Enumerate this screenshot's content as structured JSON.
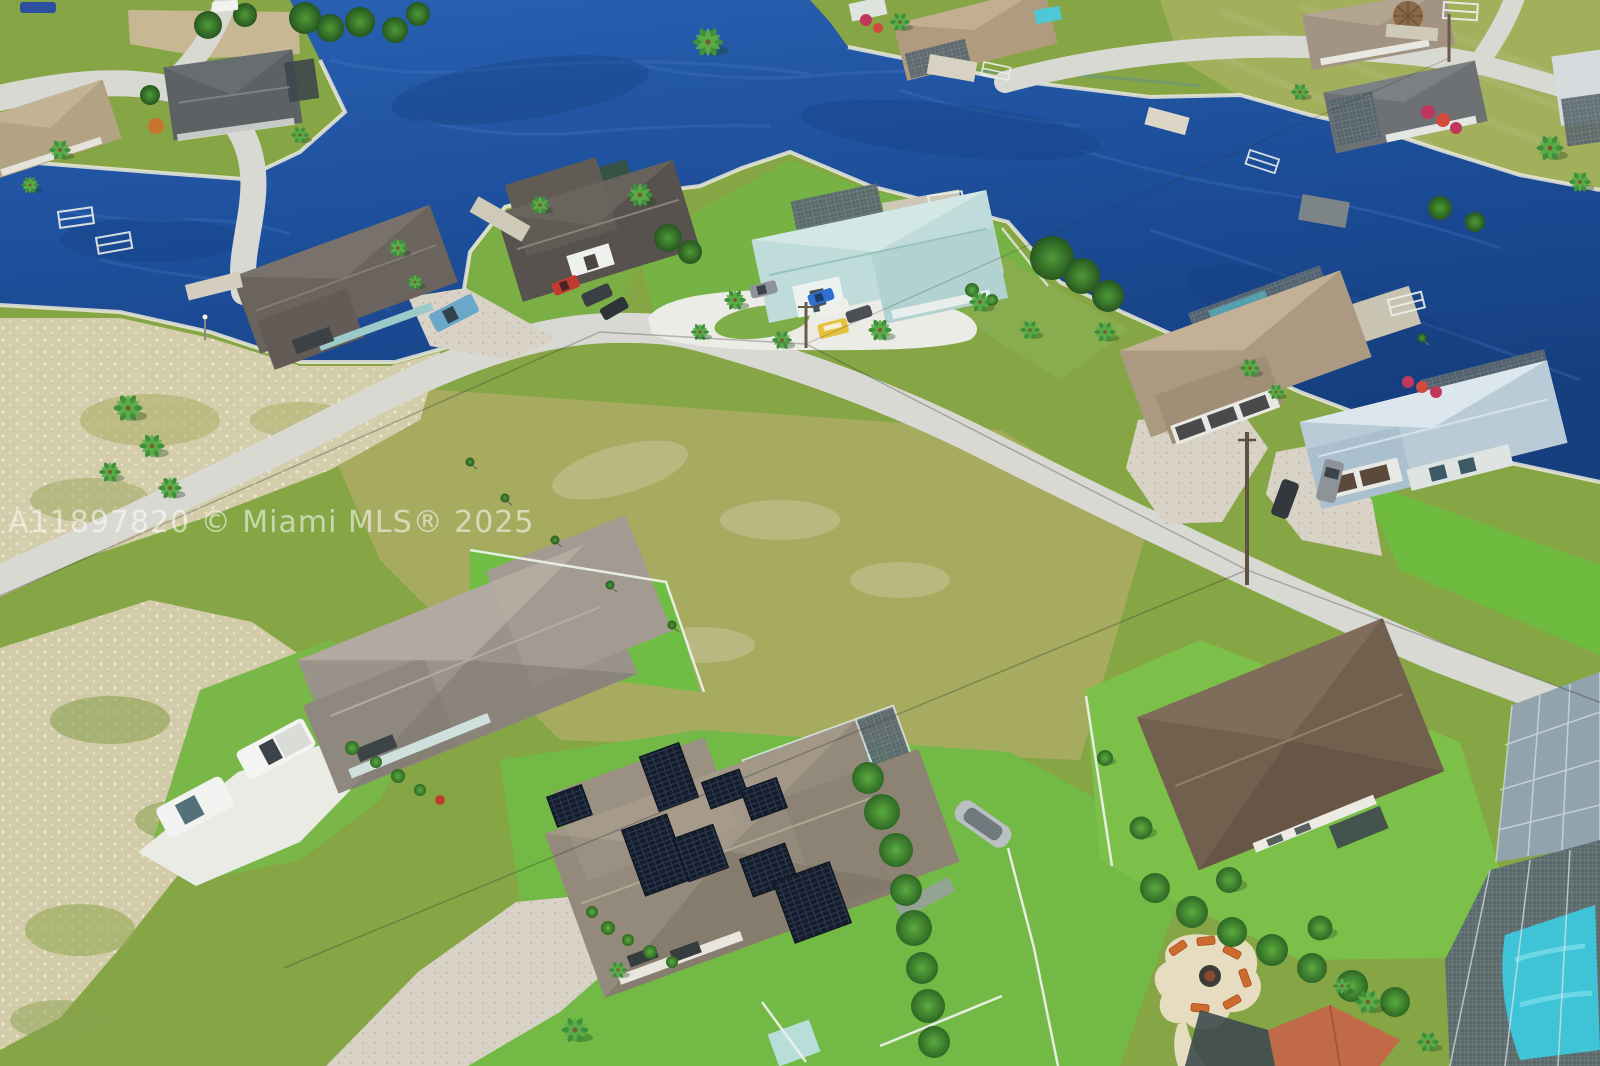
{
  "watermark": {
    "text": "A11897820 © Miami MLS® 2025"
  },
  "scene": {
    "type": "aerial-drone-photograph",
    "setting": "waterfront residential neighborhood with saltwater canals",
    "water": {
      "color": "#1d4f9b",
      "features": [
        "main canal basin",
        "left canal arm",
        "right canal"
      ]
    },
    "subject_home": {
      "roof": "taupe shingle",
      "features": [
        "rooftop solar panel arrays",
        "screened pool enclosure",
        "turquoise pool",
        "paver driveway",
        "fenced yard"
      ]
    },
    "neighborhood_features": [
      "docks and boat lifts",
      "screened lanais",
      "palm trees",
      "vacant sandy lots",
      "fire pit patio with lounge chairs",
      "white privacy fences",
      "utility poles and power lines",
      "curved residential streets"
    ],
    "vehicles": [
      "blue car",
      "white van",
      "teal pickup",
      "red car",
      "dark suv",
      "dark car",
      "gray suv",
      "blue sports car",
      "white pickup",
      "dark gray car",
      "yellow van",
      "gray suv",
      "dark car",
      "white suv",
      "white pickup truck",
      "boat on trailer"
    ],
    "palette": {
      "water": "#1d4f9b",
      "grass_bright": "#72ba45",
      "grass_dry": "#a6ab60",
      "sand": "#d4cdab",
      "road": "#d8d9d3",
      "concrete": "#eaece5",
      "paver": "#d8d3c6",
      "pool": "#49cbd9",
      "solar_panel": "#151d2b",
      "roof_taupe": "#948a7b",
      "roof_brown": "#72604f",
      "roof_teal": "#c0dcda",
      "roof_blue": "#b9cbd7",
      "roof_charcoal": "#57524e",
      "roof_gray": "#9a938a",
      "roof_terracotta": "#c06a48"
    }
  }
}
